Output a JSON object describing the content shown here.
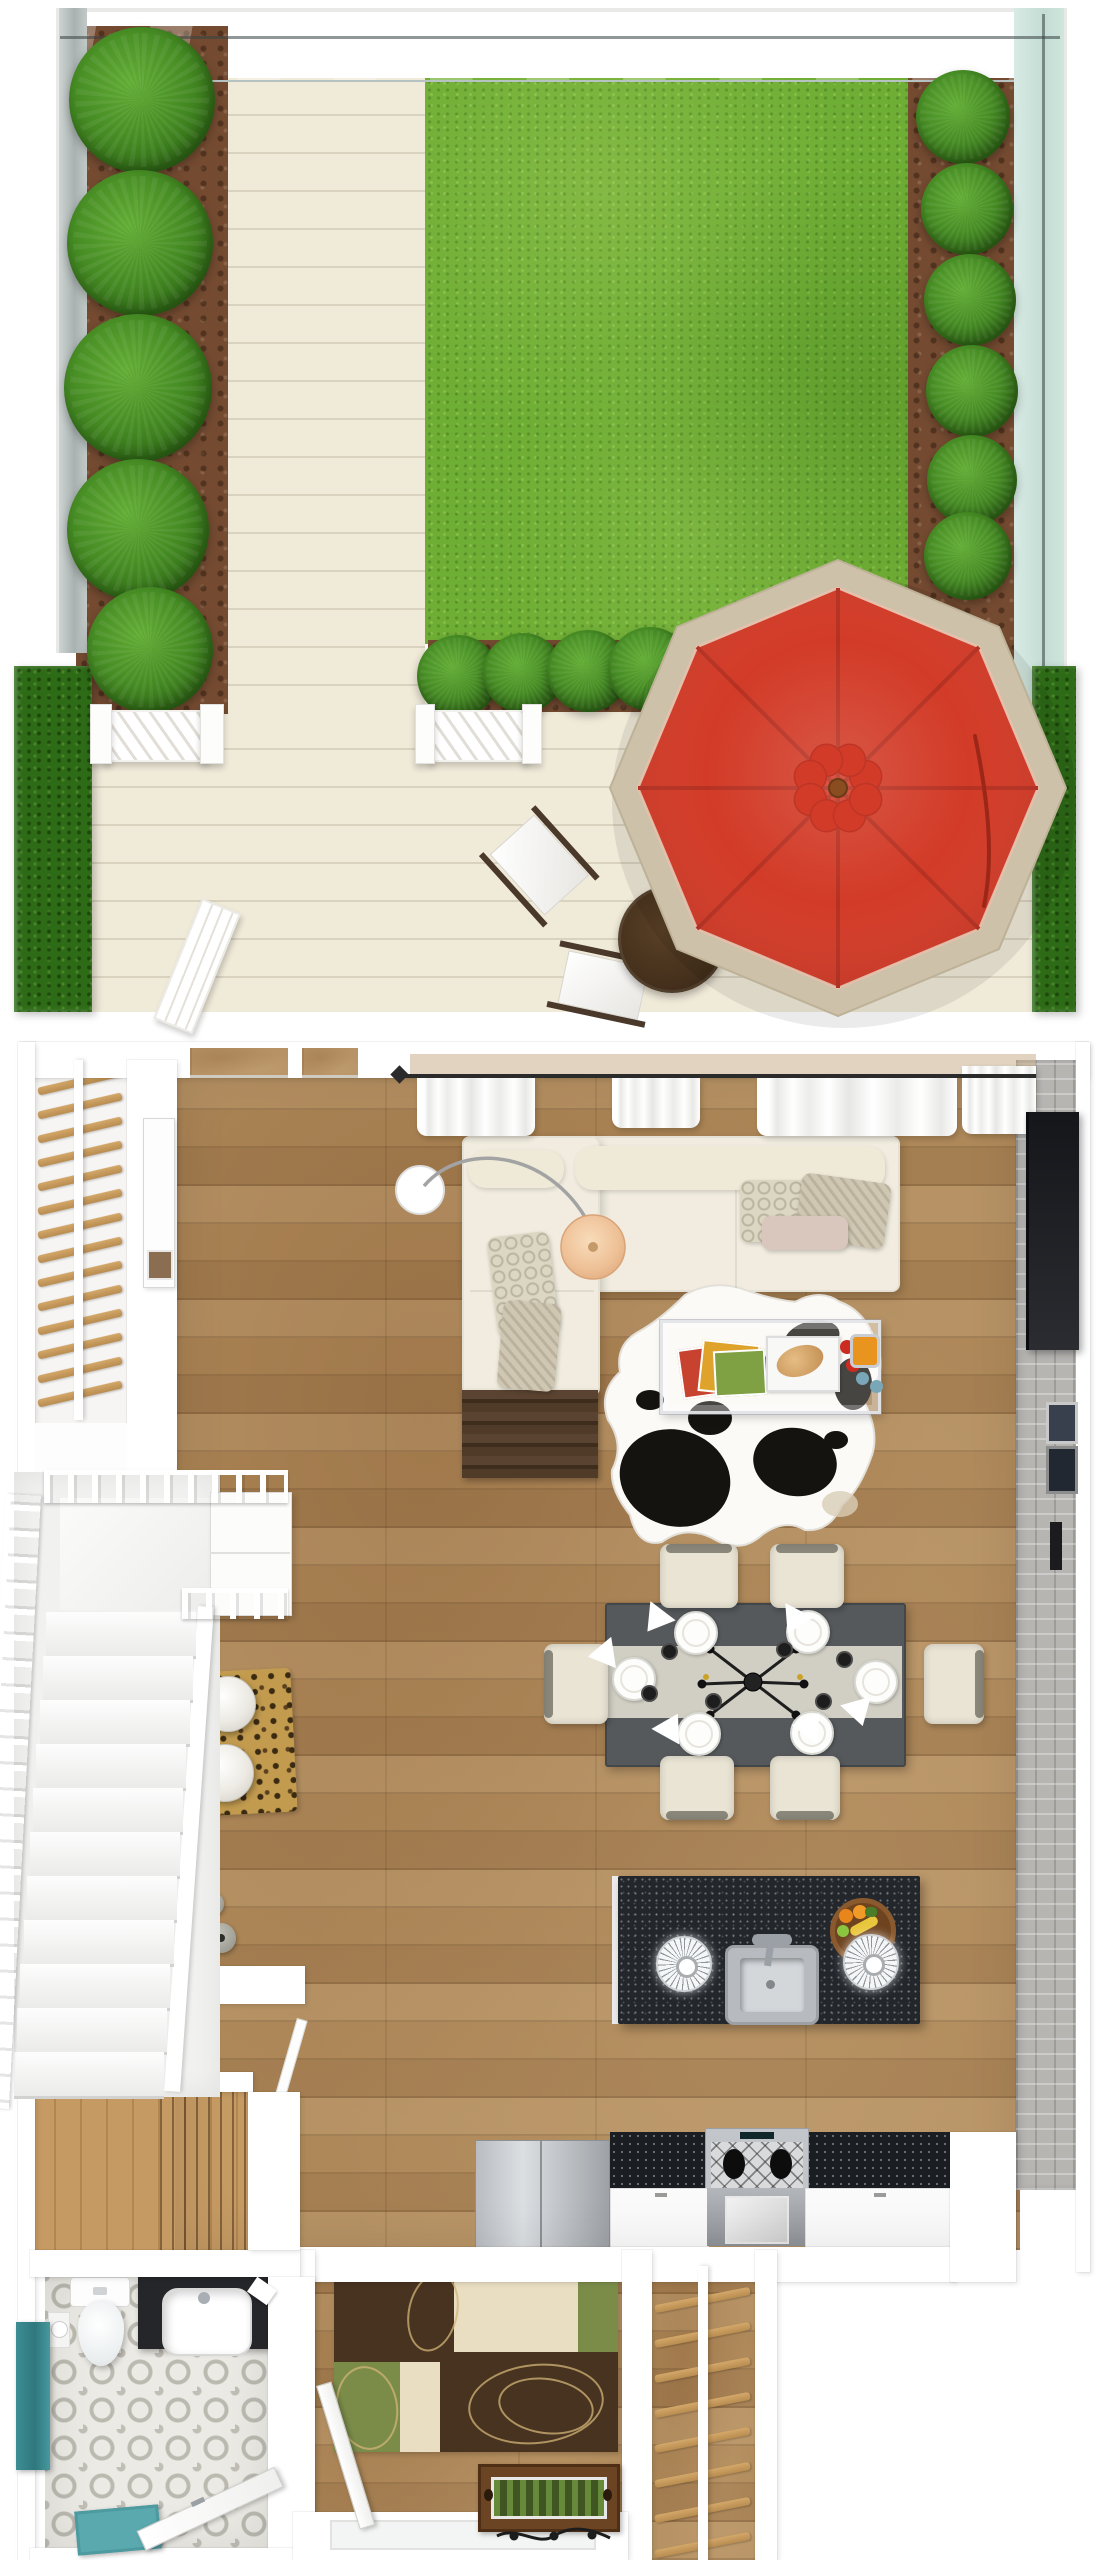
{
  "meta": {
    "title": "3D floor plan render – garden level, top-down view",
    "visible_text": "none"
  },
  "palette": {
    "lawn": "#6fae35",
    "bush": "#468c24",
    "soil": "#744b31",
    "deck": "#f0ead9",
    "deckline": "#d9d2bf",
    "glass": "#cfe3e6",
    "hedge": "#2e6b17",
    "umbrellaRed": "#d23b27",
    "umbrellaRedDark": "#b63122",
    "umbrellaRim": "#cdc2a9",
    "wood": "#ae8859",
    "wall": "#ffffff",
    "brick": "#b7b5b2",
    "sofa": "#f1ecdf",
    "darkTable": "#4e3827",
    "dining": "#55595c",
    "runner": "#d6d3c8",
    "chair": "#e9e4d4",
    "island": "#23272c",
    "steel": "#c3c7cb",
    "teal": "#3c8d94",
    "rugBrown": "#47331f",
    "rugCream": "#e9dec2",
    "rugGreen": "#7b8c49",
    "leopard": "#c29b4f",
    "tile": "#eceae4"
  },
  "garden": {
    "name": "backyard-garden",
    "objects": [
      "glass-fence",
      "lawn",
      "planting-beds",
      "round-bushes",
      "white-deck",
      "picket-fences",
      "open-gate",
      "hedges",
      "patio-umbrella-red",
      "round-wood-table",
      "sling-chairs"
    ]
  },
  "interior": {
    "rooms": [
      "living-room",
      "dining-area",
      "kitchen",
      "entry-hall",
      "bathroom",
      "staircase",
      "closet"
    ],
    "objects": [
      "sectional-sofa",
      "arc-floor-lamp",
      "glass-coffee-table",
      "cowhide-rug",
      "tv-media-wall",
      "dining-table-6-chairs",
      "kitchen-island-sink",
      "pendant-lamps",
      "fridge",
      "gas-stove",
      "white-stairs",
      "ladder-stairs",
      "leopard-rug",
      "toilet",
      "vanity-sink",
      "geometric-rug",
      "planter-box"
    ]
  },
  "scene": {
    "garden_bushes": [
      {
        "x": 142,
        "y": 100,
        "d": 146
      },
      {
        "x": 140,
        "y": 243,
        "d": 146
      },
      {
        "x": 138,
        "y": 388,
        "d": 148
      },
      {
        "x": 138,
        "y": 530,
        "d": 142
      },
      {
        "x": 150,
        "y": 650,
        "d": 126
      },
      {
        "x": 963,
        "y": 117,
        "d": 94
      },
      {
        "x": 967,
        "y": 209,
        "d": 92
      },
      {
        "x": 970,
        "y": 300,
        "d": 92
      },
      {
        "x": 972,
        "y": 391,
        "d": 92
      },
      {
        "x": 972,
        "y": 480,
        "d": 90
      },
      {
        "x": 968,
        "y": 556,
        "d": 88
      },
      {
        "x": 458,
        "y": 676,
        "d": 82
      },
      {
        "x": 523,
        "y": 673,
        "d": 80
      },
      {
        "x": 588,
        "y": 671,
        "d": 82
      },
      {
        "x": 650,
        "y": 669,
        "d": 84
      }
    ],
    "upper_rungs": {
      "left": 37,
      "width": 86,
      "top": 1078,
      "step": 24,
      "count": 14,
      "angle": -13
    },
    "lower_rungs": {
      "left": 654,
      "width": 97,
      "top": 2296,
      "step": 35,
      "count": 8,
      "angle": -11
    },
    "steps": {
      "left": 46,
      "top": 1612,
      "width": 150,
      "height": 44,
      "count": 11,
      "shift": -3.2
    },
    "plates": [
      [
        694,
        1631
      ],
      [
        806,
        1630
      ],
      [
        697,
        1732
      ],
      [
        810,
        1731
      ],
      [
        632,
        1677
      ],
      [
        874,
        1680
      ]
    ],
    "cups": [
      [
        668,
        1650
      ],
      [
        783,
        1648
      ],
      [
        843,
        1658
      ],
      [
        648,
        1692
      ],
      [
        712,
        1700
      ],
      [
        822,
        1700
      ]
    ],
    "napkins": [
      {
        "x": 645,
        "y": 1605,
        "r": 18
      },
      {
        "x": 783,
        "y": 1605,
        "r": 8
      },
      {
        "x": 652,
        "y": 1712,
        "r": 190
      },
      {
        "x": 792,
        "y": 1710,
        "r": 196
      },
      {
        "x": 590,
        "y": 1642,
        "r": 62
      },
      {
        "x": 846,
        "y": 1694,
        "r": -35
      }
    ],
    "dining_chairs": [
      {
        "x": 660,
        "y": 1544,
        "w": 78,
        "h": 64,
        "s": "top"
      },
      {
        "x": 770,
        "y": 1544,
        "w": 74,
        "h": 64,
        "s": "top"
      },
      {
        "x": 660,
        "y": 1756,
        "w": 74,
        "h": 64,
        "s": "bottom"
      },
      {
        "x": 770,
        "y": 1756,
        "w": 70,
        "h": 64,
        "s": "bottom"
      },
      {
        "x": 544,
        "y": 1644,
        "w": 64,
        "h": 80,
        "s": "left"
      },
      {
        "x": 924,
        "y": 1644,
        "w": 60,
        "h": 80,
        "s": "right"
      }
    ],
    "pendants": [
      [
        682,
        1962
      ],
      [
        869,
        1960
      ]
    ],
    "vases": [
      [
        205,
        1930,
        26
      ],
      [
        221,
        1938,
        30
      ],
      [
        212,
        1904,
        24
      ]
    ]
  }
}
